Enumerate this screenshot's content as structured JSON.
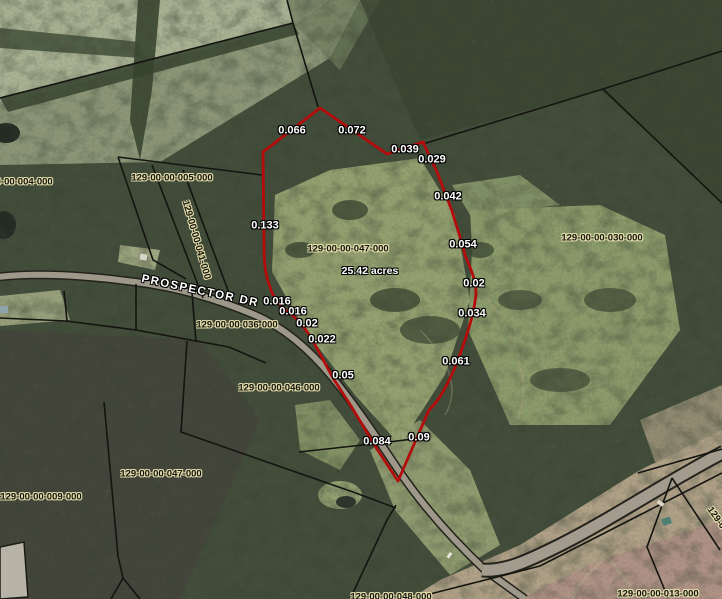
{
  "map": {
    "road_name": "PROSPECTOR DR",
    "highlighted_parcel": {
      "id": "129-00-00-047-000",
      "acreage": "25.42 acres"
    },
    "parcel_labels": [
      {
        "text": "129-00-00-004-000"
      },
      {
        "text": "129-00-00-005-000"
      },
      {
        "text": "129-00-00-041-000"
      },
      {
        "text": "129-00-00-047-000"
      },
      {
        "text": "129-00-00-036-000"
      },
      {
        "text": "129-00-00-030-000"
      },
      {
        "text": "129-00-00-046-000"
      },
      {
        "text": "129-00-00-047-000"
      },
      {
        "text": "129-00-00-009-000"
      },
      {
        "text": "129-00-00-013-000"
      },
      {
        "text": "129-00-00-048-000"
      },
      {
        "text": "129-0"
      }
    ],
    "segment_labels": [
      {
        "text": "0.066"
      },
      {
        "text": "0.072"
      },
      {
        "text": "0.039"
      },
      {
        "text": "0.029"
      },
      {
        "text": "0.042"
      },
      {
        "text": "0.054"
      },
      {
        "text": "0.02"
      },
      {
        "text": "0.034"
      },
      {
        "text": "0.061"
      },
      {
        "text": "0.09"
      },
      {
        "text": "0.084"
      },
      {
        "text": "0.05"
      },
      {
        "text": "0.133"
      },
      {
        "text": "0.016"
      },
      {
        "text": "0.016"
      },
      {
        "text": "0.02"
      },
      {
        "text": "0.022"
      }
    ]
  },
  "colors": {
    "highlight_boundary": "#b40b0b",
    "parcel_line": "#141410",
    "label_halo": "#e6dfae",
    "road_fill": "#9e988a"
  }
}
